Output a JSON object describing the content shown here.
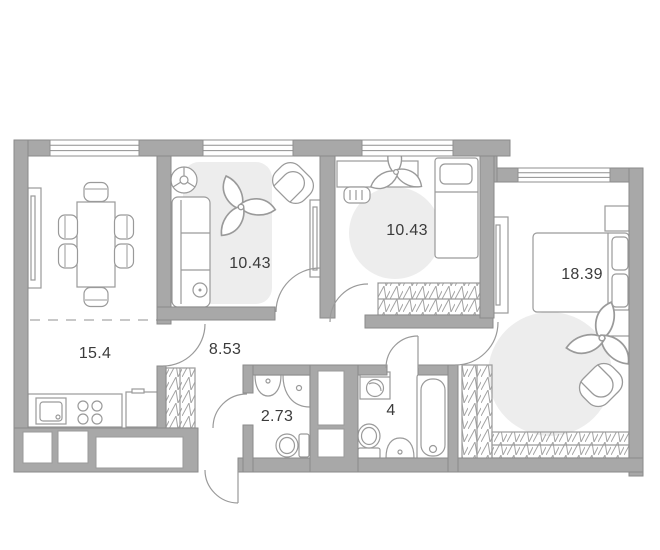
{
  "plan": {
    "type": "apartment-floor-plan",
    "rooms": [
      {
        "id": "kitchen-living-room",
        "area": "15.4"
      },
      {
        "id": "bedroom-1",
        "area": "10.43"
      },
      {
        "id": "bedroom-2",
        "area": "10.43"
      },
      {
        "id": "bedroom-3",
        "area": "18.39"
      },
      {
        "id": "hallway",
        "area": "8.53"
      },
      {
        "id": "bathroom",
        "area": "2.73"
      },
      {
        "id": "bathroom-wc",
        "area": "4"
      }
    ],
    "colors": {
      "wall": "#a8a8a8",
      "wall_outline": "#8a8a8a",
      "furniture_line": "#9a9a9a",
      "rug": "#ededed",
      "label_text": "#3b3b3b",
      "background": "#ffffff"
    },
    "icons": [
      "dining-table",
      "dining-chair",
      "sideboard",
      "kitchen-sink",
      "cooktop",
      "fridge",
      "wall-niche",
      "sofa",
      "fan",
      "plant",
      "armchair",
      "mirror-wardrobe",
      "rug",
      "desk",
      "desk-chair",
      "single-bed",
      "wardrobe",
      "double-bed",
      "nightstand",
      "side-table",
      "washbasin",
      "corner-shower",
      "toilet",
      "washing-machine",
      "bathtub",
      "ventilation-shaft",
      "window",
      "door-swing",
      "entry-door-swing",
      "zone-divider"
    ]
  }
}
